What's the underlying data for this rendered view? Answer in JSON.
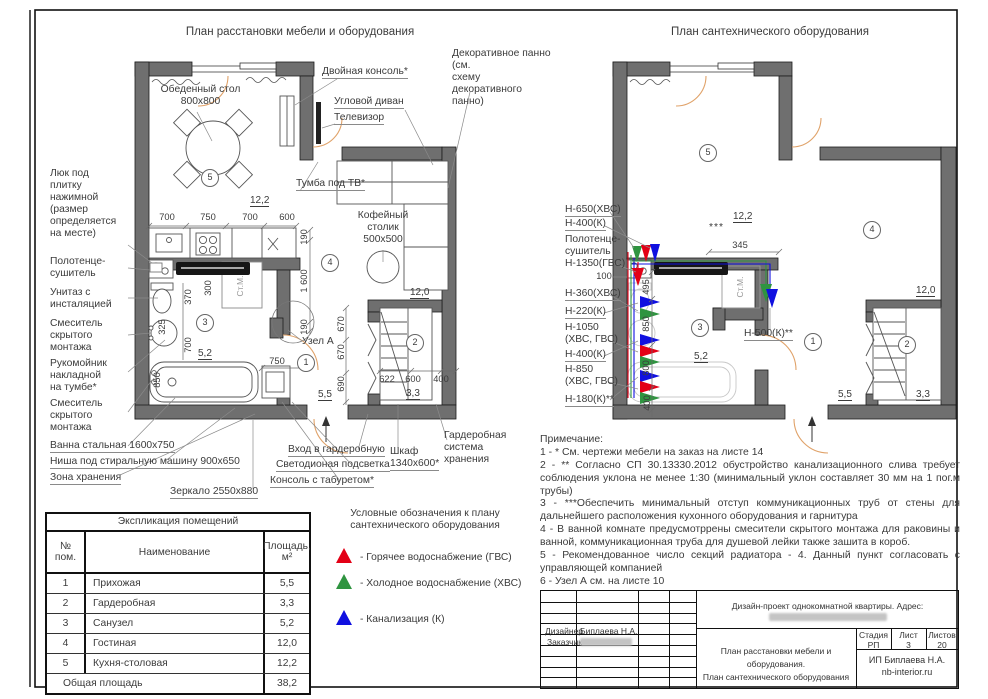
{
  "titles": {
    "left": "План расстановки мебели и оборудования",
    "right": "План сантехнического оборудования"
  },
  "L": {
    "c": {
      "dining": "Обеденный стол\n800x800",
      "console2": "Двойная консоль*",
      "sofa": "Угловой диван",
      "tv": "Телевизор",
      "decor": "Декоративное панно (см.\nсхему декоративного\nпанно)",
      "tvstand": "Тумба под ТВ*",
      "coffee": "Кофейный\nстолик\n500x500",
      "hatch": "Люк под\nплитку\nнажимной\n(размер\nопределяется\nна месте)",
      "towel": "Полотенце-\nсушитель",
      "wc": "Унитаз с\nинсталяцией",
      "mixer1": "Смеситель\nскрытого\nмонтажа",
      "sink": "Рукомойник\nнакладной\nна тумбе*",
      "mixer2": "Смеситель\nскрытого\nмонтажа",
      "bath": "Ванна стальная 1600x750",
      "niche": "Ниша под стиральную машину 900x650",
      "zone": "Зона хранения",
      "mirror": "Зеркало 2550x880",
      "node": "Узел А",
      "entry": "Вход в гардеробную",
      "led": "Светодионая подсветка",
      "stool": "Консоль с табуретом*",
      "shkaf": "Шкаф\n1340x600*",
      "gard": "Гардеробная\nсистема\nхранения",
      "stm": "Ст.М."
    },
    "d": {
      "a": "700",
      "b": "750",
      "c": "700",
      "dd": "600",
      "k": "12,2",
      "e": "190",
      "f": "1 600",
      "g": "190",
      "h": "370",
      "i": "300",
      "j": "325",
      "l": "700",
      "m": "850",
      "n": "5,2",
      "o": "750",
      "p": "5,5",
      "q": "670",
      "r": "670",
      "s": "690",
      "t": "622",
      "u": "600",
      "v": "400",
      "w": "3,3",
      "x": "12,0"
    },
    "rooms": {
      "r5": "5",
      "r3": "3",
      "r4": "4",
      "r1": "1",
      "r2": "2"
    }
  },
  "R": {
    "lab": {
      "l1": "Н-650(ХВС)",
      "l2": "Н-400(К)",
      "l3": "Полотенце-\nсушитель\nН-1350(ГВС)",
      "l4": "100",
      "l5": "Н-360(ХВС)",
      "l6": "Н-220(К)",
      "l7": "Н-1050\n(ХВС, ГВС)",
      "l8": "Н-400(К)",
      "l9": "Н-850\n(ХВС, ГВС)",
      "l10": "Н-180(К)**",
      "l11": "Н-500(К)**",
      "stars": "***",
      "stm": "Ст.М."
    },
    "d": {
      "a": "12,2",
      "b": "345",
      "c": "495",
      "dd": "850",
      "e": "800",
      "f": "400",
      "g": "5,2",
      "h": "12,0",
      "i": "5,5",
      "j": "3,3"
    },
    "rooms": {
      "r5": "5",
      "r3": "3",
      "r1": "1",
      "r2": "2",
      "r4": "4"
    }
  },
  "legend": {
    "title": "Условные обозначения к плану\nсантехнического оборудования",
    "items": [
      {
        "color": "#e30016",
        "label": "- Горячее водоснабжение (ГВС)"
      },
      {
        "color": "#2f9440",
        "label": "- Холодное водоснабжение (ХВС)"
      },
      {
        "color": "#1010e0",
        "label": "- Канализация (К)"
      }
    ]
  },
  "table": {
    "title": "Экспликация помещений",
    "col1": "№\nпом.",
    "col2": "Наименование",
    "col3": "Площадь,\nм²",
    "rows": [
      [
        "1",
        "Прихожая",
        "5,5"
      ],
      [
        "2",
        "Гардеробная",
        "3,3"
      ],
      [
        "3",
        "Санузел",
        "5,2"
      ],
      [
        "4",
        "Гостиная",
        "12,0"
      ],
      [
        "5",
        "Кухня-столовая",
        "12,2"
      ]
    ],
    "total_label": "Общая площадь",
    "total_value": "38,2"
  },
  "notes": {
    "title": "Примечание:",
    "items": [
      "1 - * См. чертежи мебели на заказ на листе 14",
      "2 - ** Согласно СП 30.13330.2012 обустройство канализационного слива требует соблюдения уклона не менее 1:30 (минимальный уклон составляет 30 мм на 1 пог.м трубы)",
      "3 - ***Обеспечить минимальный отступ коммуникационных труб от стены для дальнейшего расположения кухонного оборудования и гарнитура",
      "4 - В ванной комнате предусмотррены смесители скрытого монтажа для раковины и ванной, коммуникационная труба для душевой лейки также зашита в короб.",
      "5 - Рекомендованное число секций радиатора - 4. Данный пункт согласовать с управляющей компанией",
      "6 - Узел А см. на листе 10"
    ]
  },
  "tb": {
    "project": "Дизайн-проект однокомнатной квартиры. Адрес:",
    "designer_label": "Дизайнер",
    "designer_name": "Биплаева Н.А.",
    "client_label": "Заказчик",
    "sheet_title": "План расстановки мебели и оборудования.\nПлан сантехнического оборудования",
    "stage_h": "Стадия",
    "stage": "РП",
    "list_h": "Лист",
    "list": "3",
    "lists_h": "Листов",
    "lists": "20",
    "company": "ИП Биплаева Н.А.",
    "site": "nb-interior.ru"
  }
}
